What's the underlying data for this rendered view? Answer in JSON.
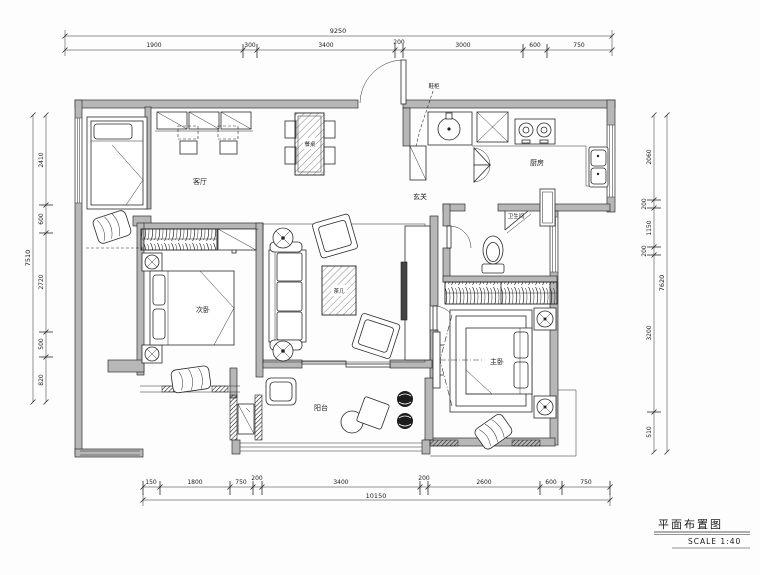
{
  "title_block": {
    "title": "平面布置图",
    "scale": "SCALE 1:40"
  },
  "labels": {
    "living": "客厅",
    "dining_table": "餐桌",
    "coffee_table": "茶几",
    "kitchen": "厨房",
    "foyer": "玄关",
    "bathroom": "卫生间",
    "bedroom2": "次卧",
    "master": "主卧",
    "balcony": "阳台",
    "shoe_cabinet_note": "鞋柜"
  },
  "dims": {
    "top": {
      "total": "9250",
      "segments": [
        "1900",
        "300",
        "3400",
        "200",
        "3000",
        "600",
        "750"
      ]
    },
    "bottom": {
      "total": "10150",
      "segments": [
        "150",
        "1800",
        "750",
        "200",
        "3400",
        "200",
        "2600",
        "600",
        "750"
      ]
    },
    "left": {
      "total": "7510",
      "segments": [
        "2410",
        "600",
        "2720",
        "500",
        "820"
      ]
    },
    "right": {
      "total": "7620",
      "segments": [
        "2060",
        "200",
        "1150",
        "200",
        "3200",
        "510"
      ]
    }
  }
}
